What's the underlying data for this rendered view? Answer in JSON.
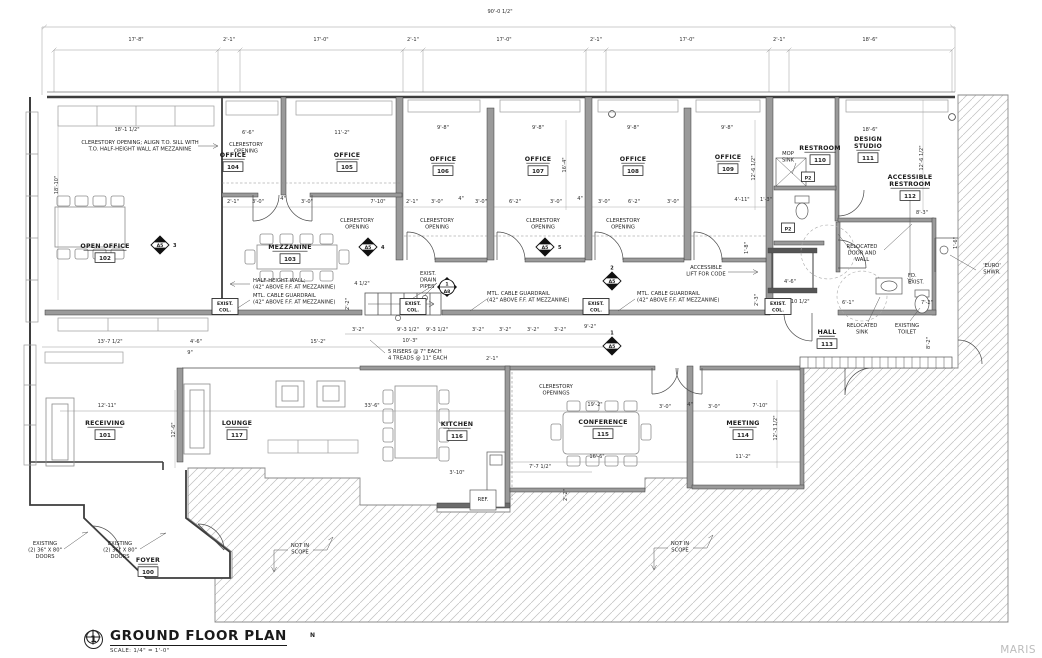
{
  "title_block": {
    "detail_number": "1",
    "title": "GROUND FLOOR PLAN",
    "scale": "SCALE: 1/4\" = 1'-0\"",
    "north_label": "N"
  },
  "watermark": "MARIS",
  "colors": {
    "wall": "#3d3d3d",
    "wall_fill": "#9a9a9a",
    "hatch": "#b5b5b5",
    "text": "#1c1c1c",
    "dim_text": "#2e2e2e"
  },
  "plan": {
    "rooms": [
      {
        "lines": [
          "FOYER"
        ],
        "number": "100",
        "x": 148,
        "y": 562
      },
      {
        "lines": [
          "RECEIVING"
        ],
        "number": "101",
        "x": 105,
        "y": 425
      },
      {
        "lines": [
          "OPEN OFFICE"
        ],
        "number": "102",
        "x": 105,
        "y": 248
      },
      {
        "lines": [
          "MEZZANINE"
        ],
        "number": "103",
        "x": 290,
        "y": 249
      },
      {
        "lines": [
          "OFFICE"
        ],
        "number": "104",
        "x": 233,
        "y": 157
      },
      {
        "lines": [
          "OFFICE"
        ],
        "number": "105",
        "x": 347,
        "y": 157
      },
      {
        "lines": [
          "OFFICE"
        ],
        "number": "106",
        "x": 443,
        "y": 161
      },
      {
        "lines": [
          "OFFICE"
        ],
        "number": "107",
        "x": 538,
        "y": 161
      },
      {
        "lines": [
          "OFFICE"
        ],
        "number": "108",
        "x": 633,
        "y": 161
      },
      {
        "lines": [
          "OFFICE"
        ],
        "number": "109",
        "x": 728,
        "y": 159
      },
      {
        "lines": [
          "RESTROOM"
        ],
        "number": "110",
        "x": 820,
        "y": 150
      },
      {
        "lines": [
          "DESIGN",
          "STUDIO"
        ],
        "number": "111",
        "x": 868,
        "y": 141
      },
      {
        "lines": [
          "ACCESSIBLE",
          "RESTROOM"
        ],
        "number": "112",
        "x": 910,
        "y": 179
      },
      {
        "lines": [
          "HALL"
        ],
        "number": "113",
        "x": 827,
        "y": 334
      },
      {
        "lines": [
          "MEETING"
        ],
        "number": "114",
        "x": 743,
        "y": 425
      },
      {
        "lines": [
          "CONFERENCE"
        ],
        "number": "115",
        "x": 603,
        "y": 424
      },
      {
        "lines": [
          "KITCHEN"
        ],
        "number": "116",
        "x": 457,
        "y": 426
      },
      {
        "lines": [
          "LOUNGE"
        ],
        "number": "117",
        "x": 237,
        "y": 425
      }
    ],
    "annotations": [
      {
        "lines": [
          "CLERESTORY OPENING; ALIGN T.O. SILL WITH",
          "T.O. HALF-HEIGHT WALL AT MEZZANINE"
        ],
        "x": 140,
        "y": 144,
        "align": "middle"
      },
      {
        "lines": [
          "CLERESTORY",
          "OPENING"
        ],
        "x": 246,
        "y": 146,
        "align": "middle"
      },
      {
        "lines": [
          "CLERESTORY",
          "OPENING"
        ],
        "x": 357,
        "y": 222,
        "align": "middle"
      },
      {
        "lines": [
          "CLERESTORY",
          "OPENING"
        ],
        "x": 437,
        "y": 222,
        "align": "middle"
      },
      {
        "lines": [
          "CLERESTORY",
          "OPENING"
        ],
        "x": 543,
        "y": 222,
        "align": "middle"
      },
      {
        "lines": [
          "CLERESTORY",
          "OPENING"
        ],
        "x": 623,
        "y": 222,
        "align": "middle"
      },
      {
        "lines": [
          "CLERESTORY",
          "OPENINGS"
        ],
        "x": 556,
        "y": 388,
        "align": "middle"
      },
      {
        "lines": [
          "HALF-HEIGHT WALL;",
          "(42\" ABOVE F.F. AT MEZZANINE)"
        ],
        "x": 253,
        "y": 282,
        "align": "start"
      },
      {
        "lines": [
          "MTL. CABLE GUARDRAIL",
          "(42\" ABOVE F.F. AT MEZZANINE)"
        ],
        "x": 253,
        "y": 297,
        "align": "start"
      },
      {
        "lines": [
          "MTL. CABLE GUARDRAIL",
          "(42\" ABOVE F.F. AT MEZZANINE)"
        ],
        "x": 487,
        "y": 295,
        "align": "start"
      },
      {
        "lines": [
          "MTL. CABLE GUARDRAIL",
          "(42\" ABOVE F.F. AT MEZZANINE)"
        ],
        "x": 637,
        "y": 295,
        "align": "start"
      },
      {
        "lines": [
          "EXIST.",
          "DRAIN",
          "PIPES"
        ],
        "x": 420,
        "y": 275,
        "align": "start"
      },
      {
        "lines": [
          "5 RISERS @ 7\" EACH",
          "4 TREADS @ 11\" EACH"
        ],
        "x": 388,
        "y": 353,
        "align": "start"
      },
      {
        "lines": [
          "MOP",
          "SINK"
        ],
        "x": 788,
        "y": 155,
        "align": "middle"
      },
      {
        "lines": [
          "ACCESSIBLE",
          "LIFT FOR CODE"
        ],
        "x": 706,
        "y": 269,
        "align": "middle"
      },
      {
        "lines": [
          "RELOCATED",
          "DOOR AND",
          "WALL"
        ],
        "x": 862,
        "y": 248,
        "align": "middle"
      },
      {
        "lines": [
          "RELOCATED",
          "SINK"
        ],
        "x": 862,
        "y": 327,
        "align": "middle"
      },
      {
        "lines": [
          "EXISTING",
          "TOILET"
        ],
        "x": 907,
        "y": 327,
        "align": "middle"
      },
      {
        "lines": [
          "'EURO'",
          "SHWR."
        ],
        "x": 992,
        "y": 267,
        "align": "middle"
      },
      {
        "lines": [
          "FD.",
          "EXIST."
        ],
        "x": 908,
        "y": 277,
        "align": "start"
      },
      {
        "lines": [
          "EXISTING",
          "(2) 36\" X 80\"",
          "DOORS"
        ],
        "x": 45,
        "y": 545,
        "align": "middle"
      },
      {
        "lines": [
          "EXISTING",
          "(2) 36\" X 80\"",
          "DOORS"
        ],
        "x": 120,
        "y": 545,
        "align": "middle"
      },
      {
        "lines": [
          "NOT IN",
          "SCOPE"
        ],
        "x": 300,
        "y": 547,
        "align": "middle"
      },
      {
        "lines": [
          "NOT IN",
          "SCOPE"
        ],
        "x": 680,
        "y": 545,
        "align": "middle"
      },
      {
        "lines": [
          "REF."
        ],
        "x": 483,
        "y": 501,
        "align": "middle"
      }
    ],
    "dimensions": [
      {
        "t": "90'-0 1/2\"",
        "x": 500,
        "y": 13
      },
      {
        "t": "17'-8\"",
        "x": 136,
        "y": 41
      },
      {
        "t": "2'-1\"",
        "x": 229,
        "y": 41
      },
      {
        "t": "17'-0\"",
        "x": 321,
        "y": 41
      },
      {
        "t": "2'-1\"",
        "x": 413,
        "y": 41
      },
      {
        "t": "17'-0\"",
        "x": 504,
        "y": 41
      },
      {
        "t": "2'-1\"",
        "x": 596,
        "y": 41
      },
      {
        "t": "17'-0\"",
        "x": 687,
        "y": 41
      },
      {
        "t": "2'-1\"",
        "x": 779,
        "y": 41
      },
      {
        "t": "18'-6\"",
        "x": 870,
        "y": 41
      },
      {
        "t": "18'-1 1/2\"",
        "x": 127,
        "y": 131
      },
      {
        "t": "6'-6\"",
        "x": 248,
        "y": 134
      },
      {
        "t": "11'-2\"",
        "x": 342,
        "y": 134
      },
      {
        "t": "9'-8\"",
        "x": 443,
        "y": 129
      },
      {
        "t": "9'-8\"",
        "x": 538,
        "y": 129
      },
      {
        "t": "9'-8\"",
        "x": 633,
        "y": 129
      },
      {
        "t": "9'-8\"",
        "x": 727,
        "y": 129
      },
      {
        "t": "18'-6\"",
        "x": 870,
        "y": 131
      },
      {
        "t": "18'-10\"",
        "x": 58,
        "y": 185,
        "r": true
      },
      {
        "t": "16'-4\"",
        "x": 566,
        "y": 165,
        "r": true
      },
      {
        "t": "12'-6 1/2\"",
        "x": 755,
        "y": 168,
        "r": true
      },
      {
        "t": "12'-6 1/2\"",
        "x": 923,
        "y": 158,
        "r": true
      },
      {
        "t": "2'-1\"",
        "x": 233,
        "y": 203
      },
      {
        "t": "3'-0\"",
        "x": 258,
        "y": 203
      },
      {
        "t": "4\"",
        "x": 283,
        "y": 200
      },
      {
        "t": "3'-0\"",
        "x": 307,
        "y": 203
      },
      {
        "t": "7'-10\"",
        "x": 378,
        "y": 203
      },
      {
        "t": "2'-1\"",
        "x": 412,
        "y": 203
      },
      {
        "t": "3'-0\"",
        "x": 437,
        "y": 203
      },
      {
        "t": "4\"",
        "x": 461,
        "y": 200
      },
      {
        "t": "3'-0\"",
        "x": 481,
        "y": 203
      },
      {
        "t": "6'-2\"",
        "x": 515,
        "y": 203
      },
      {
        "t": "3'-0\"",
        "x": 556,
        "y": 203
      },
      {
        "t": "4\"",
        "x": 580,
        "y": 200
      },
      {
        "t": "3'-0\"",
        "x": 604,
        "y": 203
      },
      {
        "t": "6'-2\"",
        "x": 634,
        "y": 203
      },
      {
        "t": "3'-0\"",
        "x": 673,
        "y": 203
      },
      {
        "t": "4'-11\"",
        "x": 742,
        "y": 201
      },
      {
        "t": "1'-3\"",
        "x": 766,
        "y": 201
      },
      {
        "t": "2'-2\"",
        "x": 349,
        "y": 304,
        "r": true
      },
      {
        "t": "4 1/2\"",
        "x": 362,
        "y": 285
      },
      {
        "t": "3'-2\"",
        "x": 358,
        "y": 331
      },
      {
        "t": "9'-3 1/2\"",
        "x": 408,
        "y": 331
      },
      {
        "t": "9'-3 1/2\"",
        "x": 437,
        "y": 331
      },
      {
        "t": "10'-3\"",
        "x": 410,
        "y": 342
      },
      {
        "t": "3'-2\"",
        "x": 478,
        "y": 331
      },
      {
        "t": "3'-2\"",
        "x": 505,
        "y": 331
      },
      {
        "t": "3'-2\"",
        "x": 533,
        "y": 331
      },
      {
        "t": "3'-2\"",
        "x": 560,
        "y": 331
      },
      {
        "t": "9'-2\"",
        "x": 590,
        "y": 328
      },
      {
        "t": "2'-10 1/2\"",
        "x": 797,
        "y": 303
      },
      {
        "t": "6'-1\"",
        "x": 848,
        "y": 304
      },
      {
        "t": "7'-2\"",
        "x": 927,
        "y": 304
      },
      {
        "t": "8'-3\"",
        "x": 922,
        "y": 214
      },
      {
        "t": "8'-2\"",
        "x": 930,
        "y": 343,
        "r": true
      },
      {
        "t": "1'-6\"",
        "x": 957,
        "y": 243,
        "r": true
      },
      {
        "t": "4'-6\"",
        "x": 790,
        "y": 283
      },
      {
        "t": "2'-3\"",
        "x": 758,
        "y": 300,
        "r": true
      },
      {
        "t": "1'-8\"",
        "x": 748,
        "y": 248,
        "r": true
      },
      {
        "t": "13'-7 1/2\"",
        "x": 110,
        "y": 343
      },
      {
        "t": "4'-6\"",
        "x": 196,
        "y": 343
      },
      {
        "t": "15'-2\"",
        "x": 318,
        "y": 343
      },
      {
        "t": "9\"",
        "x": 190,
        "y": 354
      },
      {
        "t": "12'-11\"",
        "x": 107,
        "y": 407
      },
      {
        "t": "33'-6\"",
        "x": 372,
        "y": 407
      },
      {
        "t": "19'-2\"",
        "x": 595,
        "y": 406
      },
      {
        "t": "3'-0\"",
        "x": 665,
        "y": 408
      },
      {
        "t": "4\"",
        "x": 690,
        "y": 406
      },
      {
        "t": "3'-0\"",
        "x": 714,
        "y": 408
      },
      {
        "t": "7'-10\"",
        "x": 760,
        "y": 407
      },
      {
        "t": "11'-2\"",
        "x": 743,
        "y": 458
      },
      {
        "t": "12'-3 1/2\"",
        "x": 777,
        "y": 428,
        "r": true
      },
      {
        "t": "16'-6\"",
        "x": 597,
        "y": 458
      },
      {
        "t": "7'-7 1/2\"",
        "x": 540,
        "y": 468
      },
      {
        "t": "3'-10\"",
        "x": 457,
        "y": 474
      },
      {
        "t": "2'-2\"",
        "x": 567,
        "y": 495,
        "r": true
      },
      {
        "t": "2'-1\"",
        "x": 492,
        "y": 360
      },
      {
        "t": "12'-6\"",
        "x": 175,
        "y": 430,
        "r": true
      }
    ],
    "markers": {
      "detail_diamonds": [
        {
          "label": "A5",
          "num": "3",
          "x": 160,
          "y": 245,
          "numpos": "right"
        },
        {
          "label": "A5",
          "num": "4",
          "x": 368,
          "y": 247,
          "numpos": "right"
        },
        {
          "label": "A5",
          "num": "5",
          "x": 545,
          "y": 247,
          "numpos": "right"
        },
        {
          "label": "A5",
          "num": "2",
          "x": 612,
          "y": 281,
          "numpos": "top"
        },
        {
          "label": "A5",
          "num": "1",
          "x": 612,
          "y": 346,
          "numpos": "top"
        }
      ],
      "detail_circle": {
        "label": "A8",
        "num": "1",
        "x": 447,
        "y": 287
      },
      "plumbing_tags": [
        {
          "label": "P2",
          "x": 808,
          "y": 177
        },
        {
          "label": "P2",
          "x": 788,
          "y": 228
        }
      ],
      "column_tags": [
        {
          "lines": [
            "EXIST.",
            "COL."
          ],
          "x": 225,
          "y": 305
        },
        {
          "lines": [
            "EXIST.",
            "COL."
          ],
          "x": 413,
          "y": 305
        },
        {
          "lines": [
            "EXIST.",
            "COL."
          ],
          "x": 596,
          "y": 305
        },
        {
          "lines": [
            "EXIST.",
            "COL."
          ],
          "x": 778,
          "y": 305
        }
      ]
    }
  }
}
